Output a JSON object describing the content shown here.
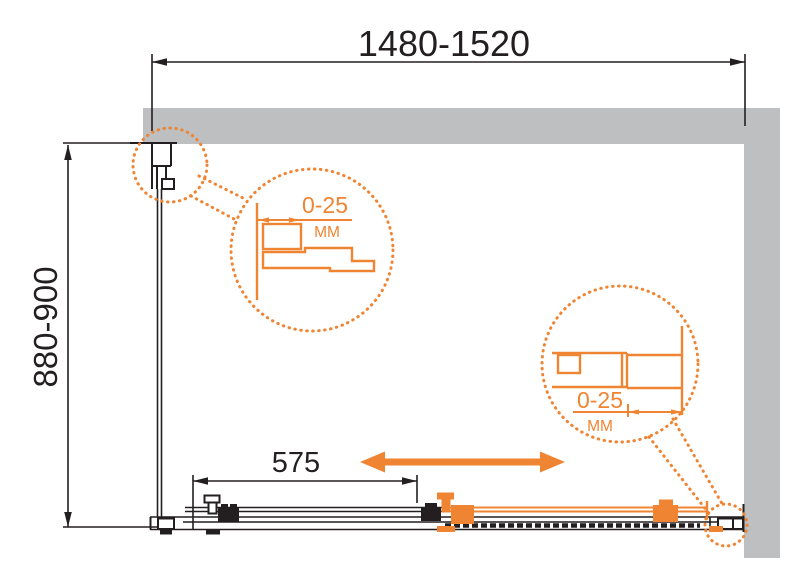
{
  "colors": {
    "accent": "#EF8432",
    "wall": "#BDBFC1",
    "line": "#231F20",
    "background": "#FFFFFF"
  },
  "dimensions": {
    "width": {
      "label": "1480-1520"
    },
    "depth": {
      "label": "880-900"
    },
    "door_width": {
      "label": "575"
    }
  },
  "callouts": {
    "left": {
      "range": "0-25",
      "unit": "ММ"
    },
    "right": {
      "range": "0-25",
      "unit": "ММ"
    }
  },
  "icons": {
    "slide_arrow": "double-headed-horizontal-arrow"
  }
}
